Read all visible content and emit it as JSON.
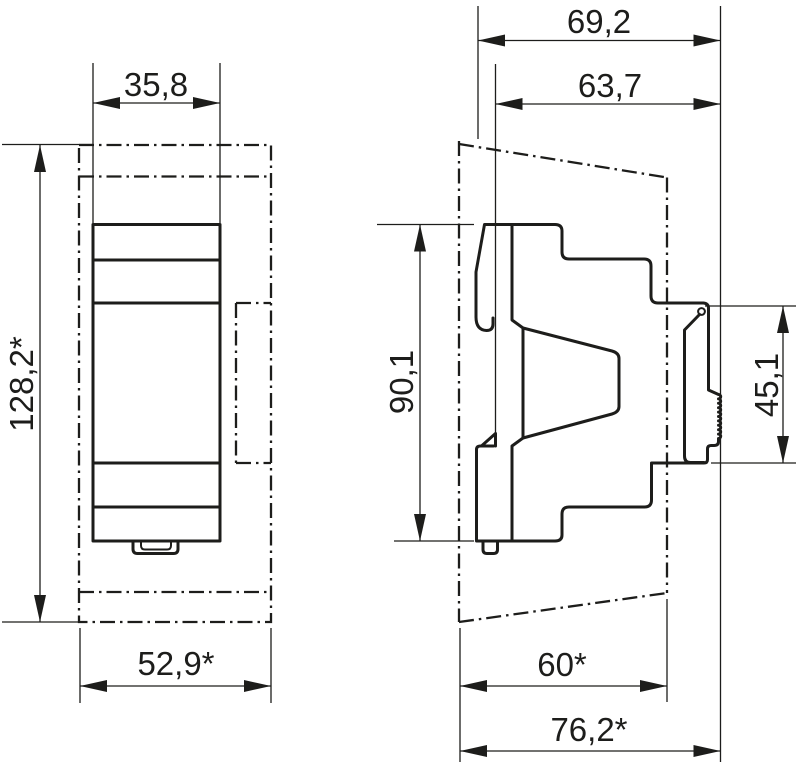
{
  "drawing": {
    "type": "dimensional technical drawing, DIN-rail device, front and side views",
    "line_color": "#1d1d1b",
    "background_color": "#ffffff"
  },
  "dimensions": {
    "front_width": "35,8",
    "front_height": "128,2*",
    "front_bottom_width": "52,9*",
    "depth_total": "69,2",
    "depth_from_rail_face": "63,7",
    "body_height": "90,1",
    "rear_height": "45,1",
    "panel_depth": "60*",
    "overall_depth": "76,2*"
  }
}
